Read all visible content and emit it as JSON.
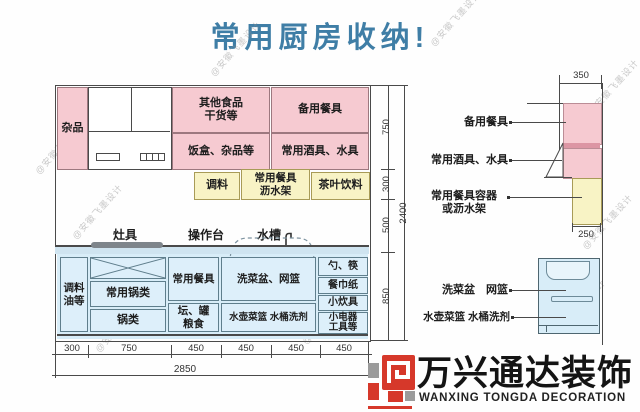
{
  "title": "常用厨房收纳!",
  "watermark_text": "@安徽飞墨设计",
  "main_diagram": {
    "upper": {
      "misc": "杂品",
      "other_food": "其他食品\n干货等",
      "spare_tableware": "备用餐具",
      "lunch_boxes": "饭盒、杂品等",
      "wine_water": "常用酒具、水具"
    },
    "shelf": {
      "seasoning": "调料",
      "drain_rack": "常用餐具\n沥水架",
      "tea_drinks": "茶叶饮料"
    },
    "counter_labels": {
      "stove": "灶具",
      "worktop": "操作台",
      "sink": "水槽"
    },
    "base": {
      "seasoning_oil": "调料\n油等",
      "common_pots": "常用锅类",
      "pots": "锅类",
      "common_tableware": "常用餐具",
      "jars_grain": "坛、罐\n粮食",
      "basin_basket": "洗菜盆、网篮",
      "kettle_bucket": "水壶菜篮 水桶洗剂",
      "spoons_chopsticks": "勺、筷",
      "napkins": "餐巾纸",
      "small_cookware": "小炊具",
      "small_appliances": "小电器\n工具等"
    },
    "dims": {
      "vertical": [
        "750",
        "300",
        "500",
        "850"
      ],
      "vertical_total": "2400",
      "bottom": [
        "300",
        "750",
        "450",
        "450",
        "450",
        "450"
      ],
      "bottom_total": "2850"
    }
  },
  "side_diagram": {
    "labels": {
      "spare_tableware": "备用餐具",
      "wine_water": "常用酒具、水具",
      "container_rack": "常用餐具容器\n或沥水架",
      "basin_basket": "洗菜盆　网篮",
      "kettle_bucket": "水壶菜篮 水桶洗剂"
    },
    "dims": {
      "top": "350",
      "shelf": "250"
    }
  },
  "logo": {
    "name_cn": "万兴通达装饰",
    "name_en": "WANXING TONGDA DECORATION"
  },
  "colors": {
    "pink": "#f6cad1",
    "yellow": "#f8f3c5",
    "blue": "#d8edf8",
    "cellblue": "#ddeffa",
    "titleblue": "#3f7ea6",
    "logored": "#d6382a"
  }
}
